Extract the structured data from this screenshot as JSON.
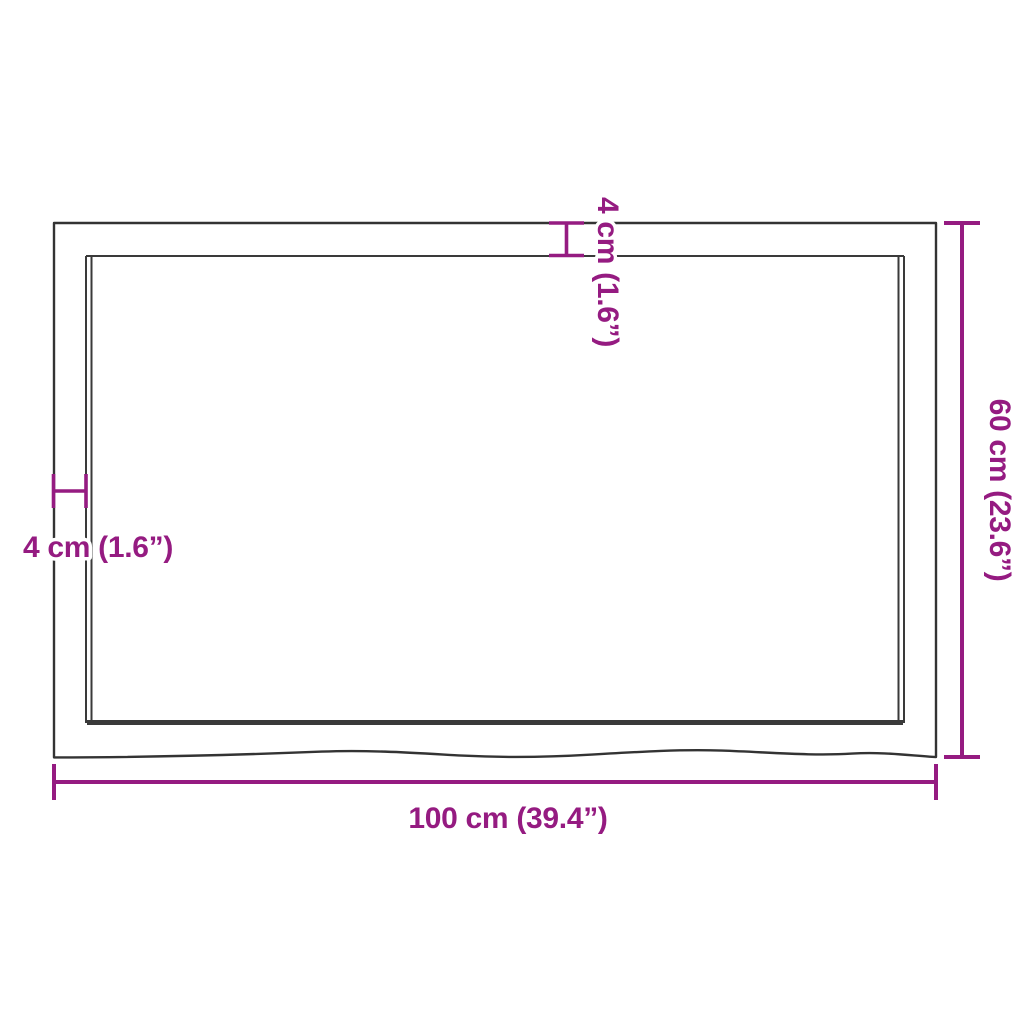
{
  "diagram": {
    "colors": {
      "dimension_accent": "#951b81",
      "outline": "#333333",
      "background": "#ffffff"
    },
    "dimensions": {
      "width_label": "100 cm (39.4”)",
      "height_label": "60 cm (23.6”)",
      "thickness_top_label": "4 cm (1.6”)",
      "thickness_left_label": "4 cm (1.6”)"
    }
  }
}
